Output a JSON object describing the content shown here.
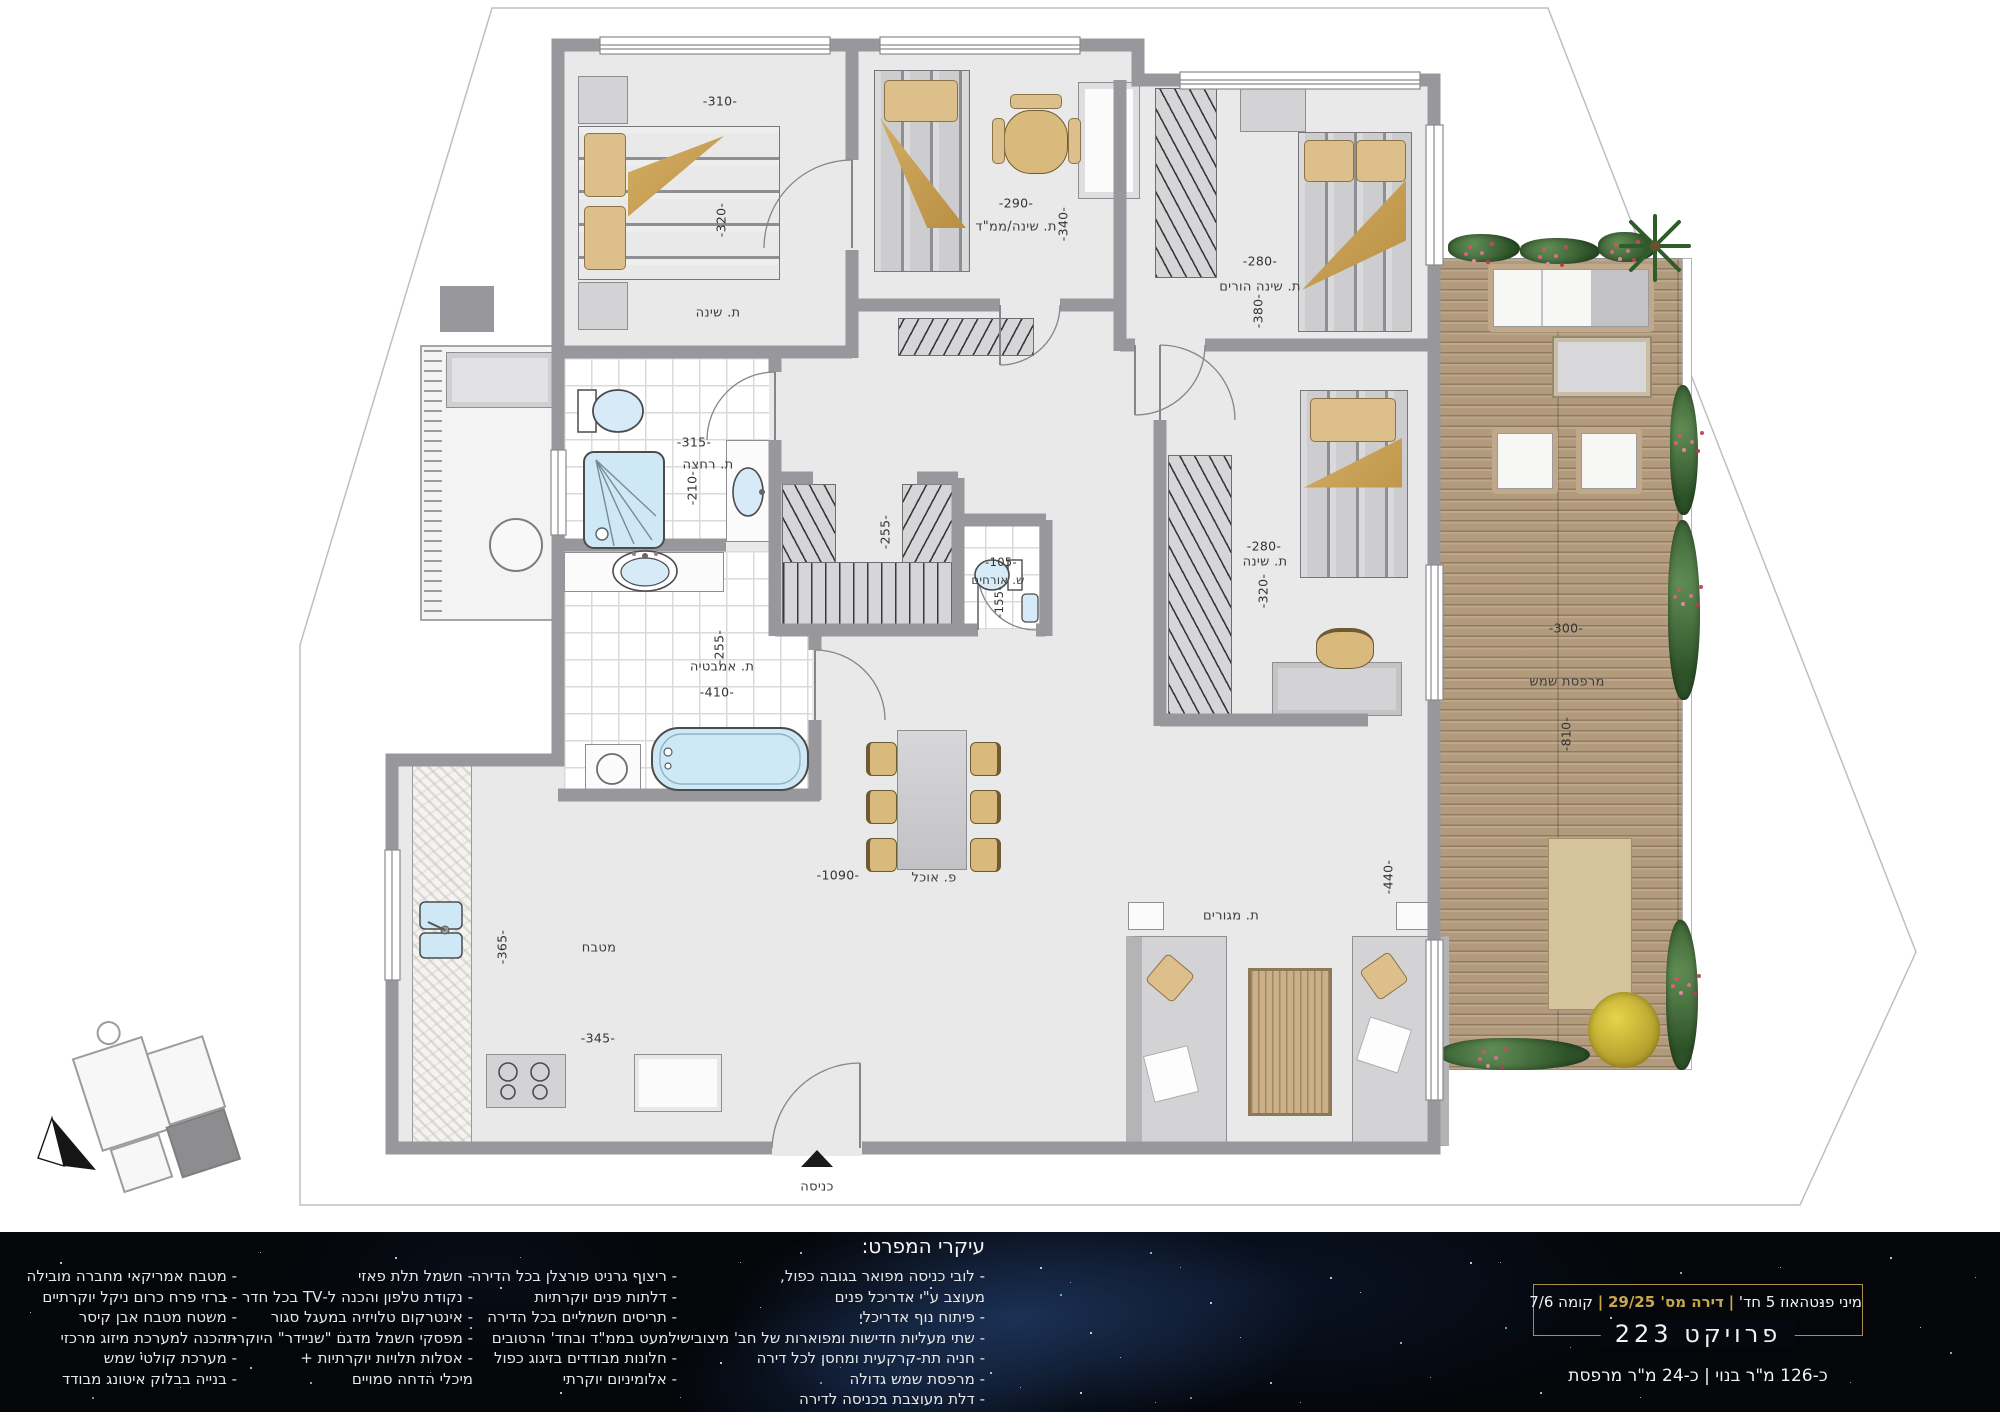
{
  "info": {
    "unit_type": "מיני פנטהאוז 5 חד'",
    "unit_number": "דירה מס' 29/25",
    "floor": "קומה 7/6",
    "sep": "|",
    "project": "פרויקט 223",
    "area": "כ-126 מ\"ר בנוי | כ-24 מ\"ר מרפסת"
  },
  "specs": {
    "title": "עיקרי המפרט:",
    "col1": [
      "- לובי כניסה מפואר בגובה כפול,",
      "מעוצב ע\"י אדריכל פנים",
      "- פיתוח נוף אדריכלי",
      "- שתי מעליות חדישות ומפוארות של חב' מיצובישי",
      "- חניה תת-קרקעית ומחסן לכל דירה",
      "- מרפסת שמש גדולה",
      "- דלת מעוצבת בכניסה לדירה"
    ],
    "col2": [
      "- ריצוף גרניט פורצלן בכל הדירה",
      "- דלתות פנים יוקרתיות",
      "- תריסים חשמליים בכל הדירה",
      "למעט בממ\"ד ובחד' הרטובים",
      "- חלונות מבודדים בזיגוג כפול",
      "- אלומיניום יוקרתי"
    ],
    "col3": [
      "- חשמל תלת פאזי",
      "- נקודת טלפון והכנה ל-TV בכל חדר",
      "- אינטרקום טלויזיה במעגל סגור",
      "- מפסקי חשמל מדגם \"שניידר\" היוקרתי",
      "- אסלות תלויות יוקרתיות +",
      "מיכלי הדחה סמויים"
    ],
    "col4": [
      "- מטבח אמריקאי מחברה מובילה",
      "- ברזי פרח כרום ניקל יוקרתיים",
      "- משטח מטבח אבן קיסר",
      "- הכנה למערכת מיזוג מרכזי",
      "- מערכת קולטי שמש",
      "- בנייה בבלוק איטונג מבודד"
    ]
  },
  "rooms": {
    "bedroom1": {
      "name": "ת. שינה",
      "width": "-310-",
      "height": "-320-"
    },
    "mamad": {
      "name": "ת. שינה/ממ\"ד",
      "width": "-290-",
      "height": "-340-"
    },
    "parents": {
      "name": "ת. שינה הורים",
      "width": "-280-",
      "height": "-380-"
    },
    "shower_room": {
      "name": "ת. רחצה",
      "width": "-315-",
      "height": "-210-"
    },
    "walkin_closet": {
      "height": "-255-"
    },
    "guest_wc": {
      "name": "ש. אורחים",
      "width": "-105-",
      "height": "-155-"
    },
    "bathroom": {
      "name": "ת. אמבטיה",
      "width": "-410-",
      "height": "-255-"
    },
    "bedroom3": {
      "name": "ת. שינה",
      "width": "-280-",
      "height": "-320-"
    },
    "kitchen": {
      "name": "מטבח",
      "width": "-345-",
      "height": "-365-"
    },
    "dining": {
      "name": "פ. אוכל",
      "width": "-1090-"
    },
    "living": {
      "name": "ת. מגורים",
      "height": "-440-"
    },
    "terrace": {
      "name": "מרפסת שמש",
      "width": "-300-",
      "height": "-810-"
    },
    "entrance": {
      "name": "כניסה"
    }
  },
  "colors": {
    "accent_gold": "#b3964d",
    "wall_gray": "#98989c",
    "deck_wood": "#b29a7d",
    "fixture_blue": "#cfe8f5"
  }
}
